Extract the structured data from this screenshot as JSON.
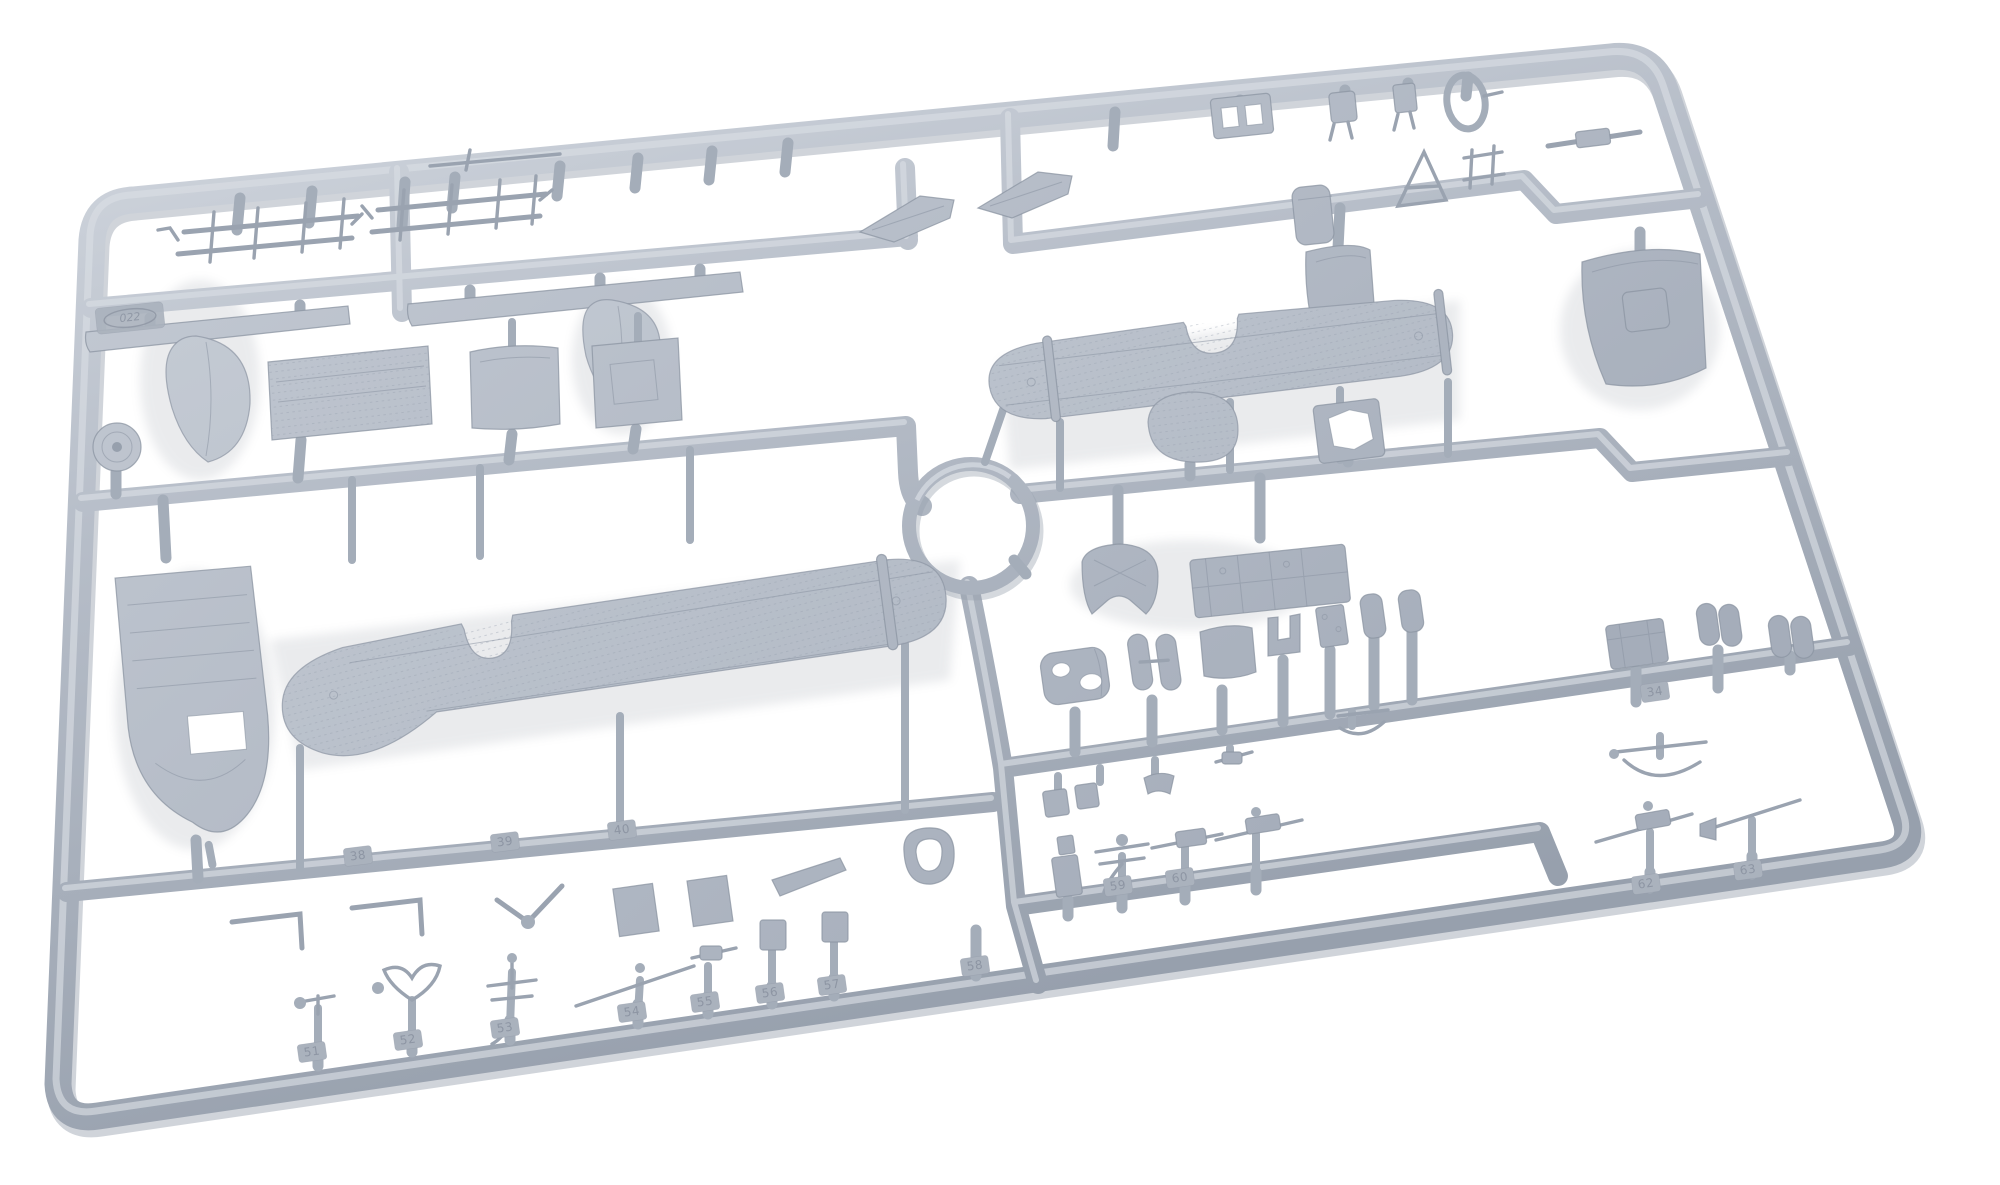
{
  "image": {
    "type": "product photograph",
    "subject": "Injection-moulded grey polystyrene model-kit sprue with biplane aircraft parts",
    "background": "white seamless",
    "alt": "Light grey plastic sprue frame, slightly rotated, holding wings, fuselage panels, struts, tanks, guns and many small numbered parts around a circular centre runner"
  },
  "colors": {
    "bg": "#ffffff",
    "hi": "#d8dde4",
    "mid": "#b6bdc8",
    "lo": "#97a0ad",
    "edge": "#8b94a2",
    "gate": "#a4adb9",
    "thin": "#9aa3b0",
    "numfill": "#aab2bd",
    "numtext": "#8d95a3",
    "shadow": "#6f7886"
  },
  "sprue": {
    "frame": "rounded rectangular outer runner, perspective-skewed",
    "center_feature": "circular runner ring hub left of centre",
    "mold_stamp": "022",
    "parts": [
      {
        "name": "upper-wing",
        "desc": "one-piece upper wing with fabric rib texture, rounded tips, centre trailing-edge cut-out"
      },
      {
        "name": "lower-wing",
        "desc": "one-piece lower wing with rounded tips and centre cut-out"
      },
      {
        "name": "tailplane-half-left",
        "desc": "flat swept stabiliser plate"
      },
      {
        "name": "tailplane-half-right",
        "desc": "flat swept stabiliser plate"
      },
      {
        "name": "fin-fairing-large",
        "desc": "tall teardrop fin / wheel spat"
      },
      {
        "name": "fin-fairing-small",
        "desc": "short teardrop fin / wheel spat"
      },
      {
        "name": "walkway-strip-short",
        "desc": "narrow tapered strip"
      },
      {
        "name": "walkway-strip-long",
        "desc": "long tapered strip"
      },
      {
        "name": "fuselage-floor",
        "desc": "long cockpit floor panel with ribs and rounded tail"
      },
      {
        "name": "fabric-deck-panel",
        "desc": "rectangular fuselage decking panel"
      },
      {
        "name": "access-panel",
        "desc": "curved cowling panel with locating pin"
      },
      {
        "name": "hatch-panel",
        "desc": "square hatch panel with locating pin"
      },
      {
        "name": "wheel-disc",
        "desc": "small wheel with hub"
      },
      {
        "name": "strut-jig-cluster",
        "desc": "two jigs of thin interplane struts"
      },
      {
        "name": "engine-mount-block",
        "desc": "small block with two openings"
      },
      {
        "name": "carburettor-fitting",
        "desc": "tiny finned fitting"
      },
      {
        "name": "pivot-bracket",
        "desc": "tiny bracket"
      },
      {
        "name": "windscreen-loop",
        "desc": "oval frame loop"
      },
      {
        "name": "ammo-drum",
        "desc": "vertical cylinder"
      },
      {
        "name": "a-frame-strut",
        "desc": "triangulated strut frame"
      },
      {
        "name": "small-jig",
        "desc": "H-shaped fitting"
      },
      {
        "name": "cowling-side-panel",
        "desc": "curved side panel"
      },
      {
        "name": "cowling-hood",
        "desc": "large curved hood with square bulge"
      },
      {
        "name": "nose-bowl",
        "desc": "oval nose cap"
      },
      {
        "name": "frame-with-opening",
        "desc": "square bulkhead with polygonal opening"
      },
      {
        "name": "headrest-fairing",
        "desc": "domed headrest with cut-outs"
      },
      {
        "name": "cockpit-frame-plate",
        "desc": "flat framework plate"
      },
      {
        "name": "fuel-drum",
        "desc": "cylindrical tank with two lightening holes"
      },
      {
        "name": "saddle-pair",
        "desc": "twin oval pads"
      },
      {
        "name": "quarter-panel",
        "desc": "small curved panel"
      },
      {
        "name": "seat-bracket",
        "desc": "U-shaped bracket"
      },
      {
        "name": "detail-plate",
        "desc": "small studded plate"
      },
      {
        "name": "canister-pair",
        "desc": "two small canisters"
      },
      {
        "name": "storage-box",
        "desc": "lidded box, tab 34"
      },
      {
        "name": "twin-bomb-pair-1",
        "desc": "paired bulged stores"
      },
      {
        "name": "twin-bomb-pair-2",
        "desc": "paired bulged stores"
      },
      {
        "name": "l-bracket-pair",
        "desc": "two angled brackets, tabs 38"
      },
      {
        "name": "v-strut",
        "desc": "vee strut, tab 39"
      },
      {
        "name": "inspection-flaps",
        "desc": "two square flaps, tabs 40/41"
      },
      {
        "name": "trim-tab-blade",
        "desc": "angled blade"
      },
      {
        "name": "oval-grommet",
        "desc": "rounded ring"
      },
      {
        "name": "hand-pump",
        "desc": "pump with horn, tab 51"
      },
      {
        "name": "wishbone-yoke",
        "desc": "forked yoke, tab 52"
      },
      {
        "name": "mast",
        "desc": "tee mast, tab 53"
      },
      {
        "name": "boom-rod",
        "desc": "long rod on post, tab 54"
      },
      {
        "name": "gun-small",
        "desc": "small gun on post, tab 55"
      },
      {
        "name": "post-with-box-56",
        "desc": "post part, tab 56"
      },
      {
        "name": "post-with-box-57",
        "desc": "post part, tab 57"
      },
      {
        "name": "plain-post-58",
        "desc": "capsule post, tab 58"
      },
      {
        "name": "totem-stack",
        "desc": "stacked fittings, tab 59"
      },
      {
        "name": "pump-with-arms",
        "desc": "pump with cross arms, tab 60"
      },
      {
        "name": "gun-on-cradle",
        "desc": "gun on mount"
      },
      {
        "name": "machine-gun",
        "desc": "long-barrelled machine gun, tab 62"
      },
      {
        "name": "venturi-gun",
        "desc": "trumpet-muzzled gun, tab 63"
      },
      {
        "name": "bombsight-bow",
        "desc": "bow with cross rod, two on sprue"
      },
      {
        "name": "sprue-gates",
        "desc": "many short rounded feed gates along all runners"
      }
    ],
    "part_number_tabs_visible": [
      "34",
      "38",
      "39",
      "40",
      "51",
      "52",
      "53",
      "54",
      "55",
      "56",
      "57",
      "58",
      "59",
      "60",
      "62",
      "63"
    ]
  },
  "labels": [
    {
      "text": "38"
    },
    {
      "text": "39"
    },
    {
      "text": "40"
    },
    {
      "text": "51"
    },
    {
      "text": "52"
    },
    {
      "text": "53"
    },
    {
      "text": "54"
    },
    {
      "text": "55"
    },
    {
      "text": "56"
    },
    {
      "text": "57"
    },
    {
      "text": "58"
    },
    {
      "text": "59"
    },
    {
      "text": "60"
    },
    {
      "text": "62"
    },
    {
      "text": "63"
    },
    {
      "text": "34"
    },
    {
      "text": "022"
    }
  ]
}
